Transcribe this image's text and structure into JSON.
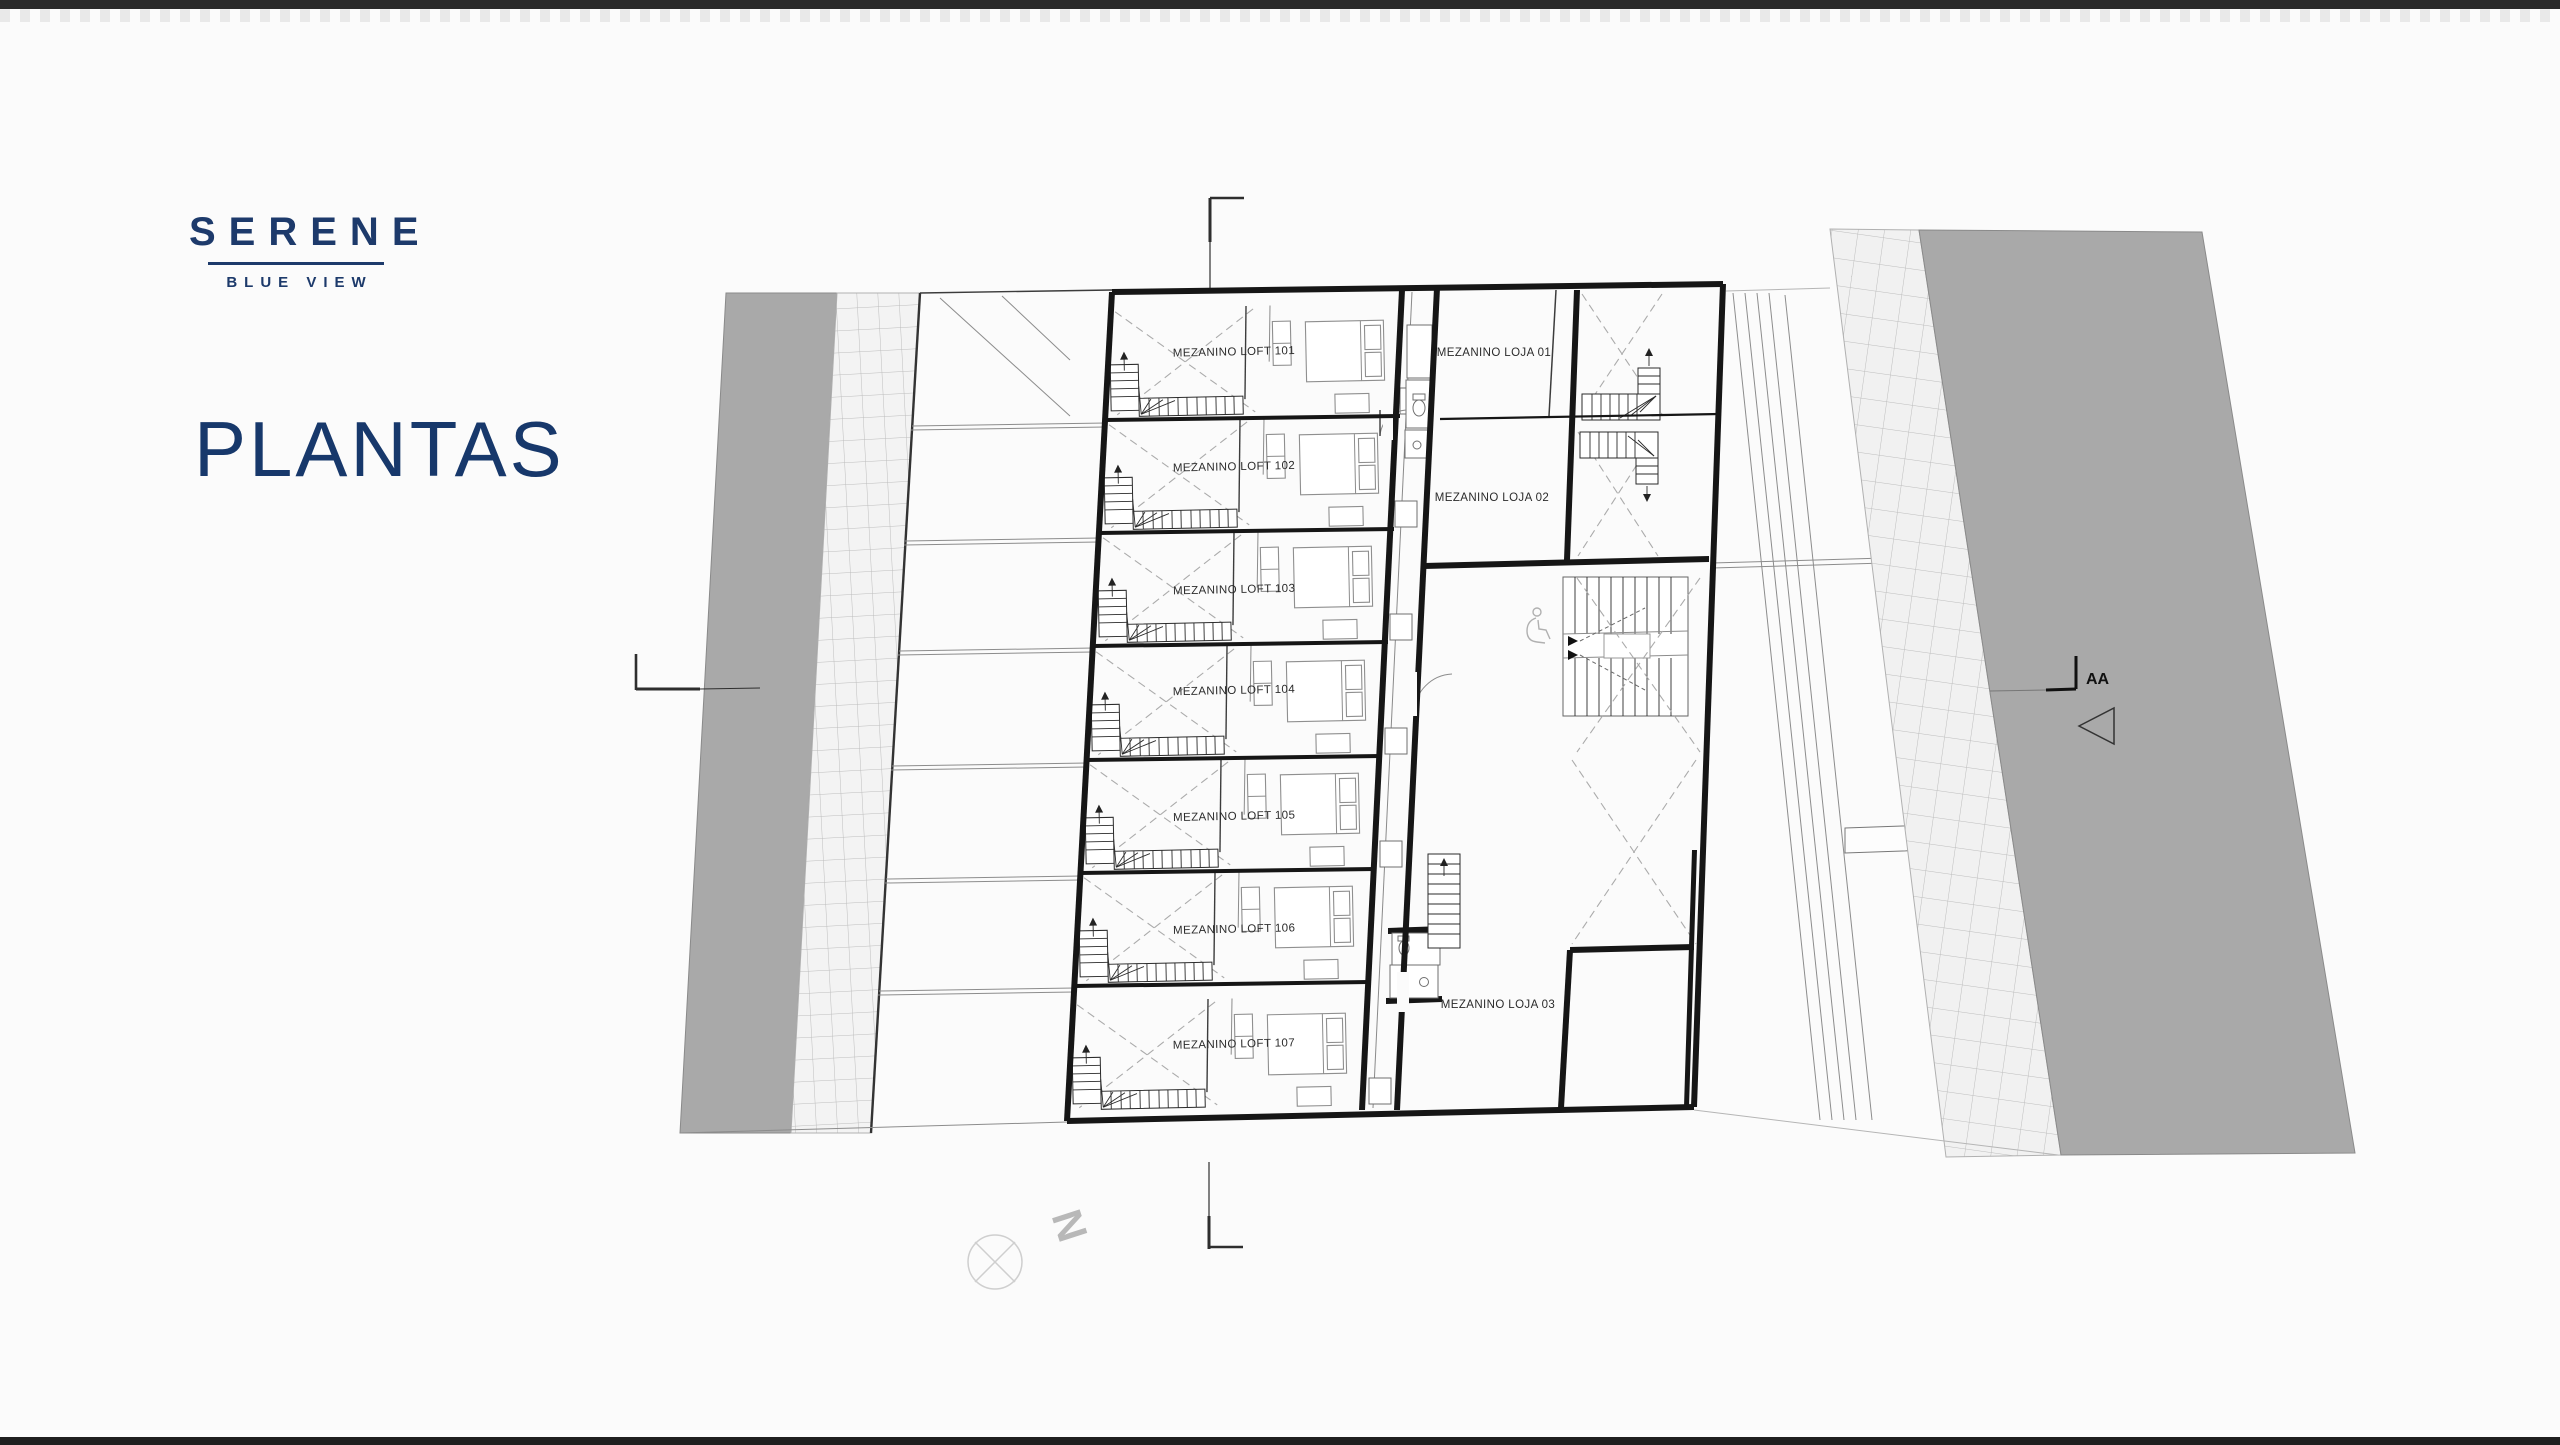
{
  "slide": {
    "background": "#fbfbfb",
    "letterbox_top_color": "#2a2a2a",
    "letterbox_bottom_color": "#1f1f1f"
  },
  "logo": {
    "name": "SERENE",
    "tagline": "BLUE VIEW",
    "color": "#1d3a6b"
  },
  "title": {
    "text": "PLANTAS",
    "color": "#17386b"
  },
  "plan": {
    "lofts": [
      {
        "label": "MEZANINO LOFT 101"
      },
      {
        "label": "MEZANINO LOFT 102"
      },
      {
        "label": "MEZANINO LOFT 103"
      },
      {
        "label": "MEZANINO LOFT 104"
      },
      {
        "label": "MEZANINO LOFT 105"
      },
      {
        "label": "MEZANINO LOFT 106"
      },
      {
        "label": "MEZANINO LOFT 107"
      }
    ],
    "lojas": [
      {
        "label": "MEZANINO LOJA 01"
      },
      {
        "label": "MEZANINO LOJA 02"
      },
      {
        "label": "MEZANINO LOJA 03"
      }
    ],
    "section_label": "AA",
    "north_label": "N",
    "colors": {
      "walls": "#161616",
      "site_fill": "#a9a9a9",
      "hatch_line": "#bdbdbd",
      "dashed_void": "#ababab"
    }
  }
}
